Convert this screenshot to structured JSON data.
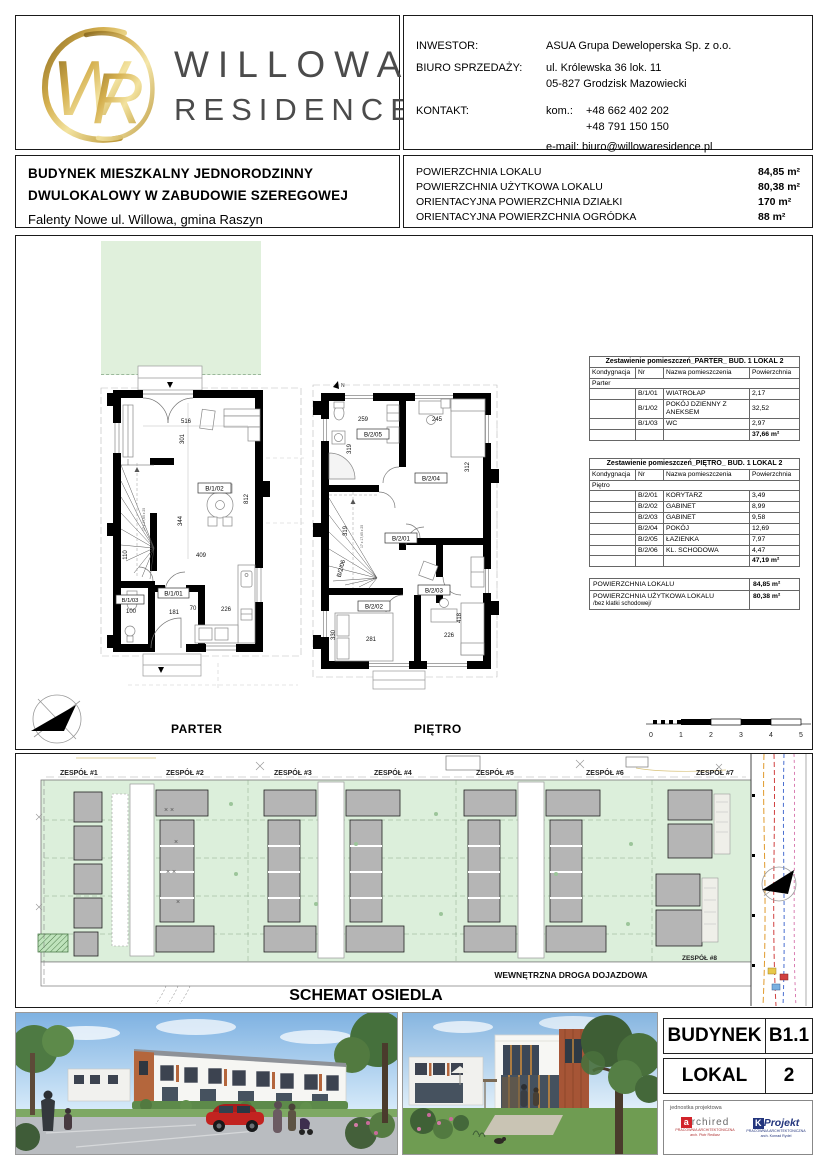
{
  "header": {
    "brand": {
      "mono_w": "W",
      "mono_r": "R",
      "line1": "WILLOWA",
      "line2": "RESIDENCE"
    },
    "contact": {
      "investor_label": "INWESTOR:",
      "investor_value": "ASUA Grupa Deweloperska Sp. z o.o.",
      "office_label": "BIURO SPRZEDAŻY:",
      "office_addr1": "ul. Królewska 36 lok. 11",
      "office_addr2": "05-827 Grodzisk Mazowiecki",
      "contact_label": "KONTAKT:",
      "phone_label": "kom.:",
      "phone1": "+48 662 402 202",
      "phone2": "+48 791 150 150",
      "email_label": "e-mail:",
      "email": "biuro@willowaresidence.pl"
    }
  },
  "info": {
    "line1": "BUDYNEK  MIESZKALNY JEDNORODZINNY",
    "line2": "DWULOKALOWY W ZABUDOWIE SZEREGOWEJ",
    "line3": "Falenty Nowe ul. Willowa,  gmina Raszyn",
    "areas": [
      {
        "label": "POWIERZCHNIA LOKALU",
        "value": "84,85 m²"
      },
      {
        "label": "POWIERZCHNIA UŻYTKOWA LOKALU",
        "value": "80,38 m²"
      },
      {
        "label": "ORIENTACYJNA POWIERZCHNIA DZIAŁKI",
        "value": "170 m²"
      },
      {
        "label": "ORIENTACYJNA POWIERZCHNIA OGRÓDKA",
        "value": "88 m²"
      }
    ]
  },
  "tables": {
    "col_kond": "Kondygnacja",
    "col_nr": "Nr",
    "col_name": "Nazwa pomieszczenia",
    "col_area": "Powierzchnia",
    "parter": {
      "title": "Zestawienie pomieszczeń_PARTER_ BUD. 1 LOKAL 2",
      "group": "Parter",
      "rows": [
        {
          "nr": "B/1/01",
          "name": "WIATROŁAP",
          "area": "2,17"
        },
        {
          "nr": "B/1/02",
          "name": "POKÓJ DZIENNY Z ANEKSEM",
          "area": "32,52"
        },
        {
          "nr": "B/1/03",
          "name": "WC",
          "area": "2,97"
        }
      ],
      "total": "37,66 m²"
    },
    "pietro": {
      "title": "Zestawienie pomieszczeń_PIĘTRO_ BUD. 1 LOKAL 2",
      "group": "Piętro",
      "rows": [
        {
          "nr": "B/2/01",
          "name": "KORYTARZ",
          "area": "3,49"
        },
        {
          "nr": "B/2/02",
          "name": "GABINET",
          "area": "8,99"
        },
        {
          "nr": "B/2/03",
          "name": "GABINET",
          "area": "9,58"
        },
        {
          "nr": "B/2/04",
          "name": "POKÓJ",
          "area": "12,69"
        },
        {
          "nr": "B/2/05",
          "name": "ŁAZIENKA",
          "area": "7,97"
        },
        {
          "nr": "B/2/06",
          "name": "KL. SCHODOWA",
          "area": "4,47"
        }
      ],
      "total": "47,19 m²"
    },
    "summary": {
      "r1l": "POWIERZCHNIA LOKALU",
      "r1v": "84,85 m²",
      "r2l": "POWIERZCHNIA UŻYTKOWA LOKALU",
      "r2n": "/bez klatki schodowej/",
      "r2v": "80,38 m²"
    }
  },
  "plans": {
    "parter_label": "PARTER",
    "pietro_label": "PIĘTRO",
    "parter": {
      "t1": "B/1/01",
      "t2": "B/1/02",
      "t3": "B/1/03",
      "d516": "516",
      "d301": "301",
      "d344": "344",
      "d409": "409",
      "d812": "812",
      "d110": "110",
      "d100": "100",
      "d181": "181",
      "d70": "70",
      "d226": "226",
      "stair_note": "17 x 17,65 x 25"
    },
    "pietro": {
      "t1": "B/2/01",
      "t2": "B/2/02",
      "t3": "B/2/03",
      "t4": "B/2/04",
      "t5": "B/2/05",
      "t6": "B/2/06",
      "d259": "259",
      "d245": "245",
      "d319a": "319",
      "d319b": "319",
      "d312": "312",
      "d330": "330",
      "d281": "281",
      "d226": "226",
      "d418": "418",
      "stair_note": "17 x 17,65 x 25"
    },
    "scalebar": {
      "s0": "0",
      "s1": "1",
      "s2": "2",
      "s3": "3",
      "s4": "4",
      "s5": "5"
    }
  },
  "siteplan": {
    "title": "SCHEMAT OSIEDLA",
    "road_label": "WEWNĘTRZNA DROGA DOJAZDOWA",
    "groups": [
      "ZESPÓŁ #1",
      "ZESPÓŁ #2",
      "ZESPÓŁ #3",
      "ZESPÓŁ #4",
      "ZESPÓŁ #5",
      "ZESPÓŁ #6",
      "ZESPÓŁ #7",
      "ZESPÓŁ #8"
    ]
  },
  "footer": {
    "budynek_label": "BUDYNEK",
    "budynek_value": "B1.1",
    "lokal_label": "LOKAL",
    "lokal_value": "2",
    "unit_label": "jednostka projektowa",
    "archired": {
      "mark": "a",
      "name": "rchired",
      "sub1": "PRACOWNIA ARCHITEKTONICZNA",
      "sub2": "arch. Piotr Redlarz"
    },
    "kprojekt": {
      "mark": "K",
      "name": "Projekt",
      "sub1": "PRACOWNIA ARCHITEKTONICZNA",
      "sub2": "arch. Konrad Rydel"
    }
  },
  "colors": {
    "gold": "#c8a24a",
    "garden_green": "#e0f0dc",
    "site_green": "#dcefdb",
    "building_grey": "#b5b5b5",
    "archired_red": "#d2232a",
    "kprojekt_blue": "#23357d"
  }
}
